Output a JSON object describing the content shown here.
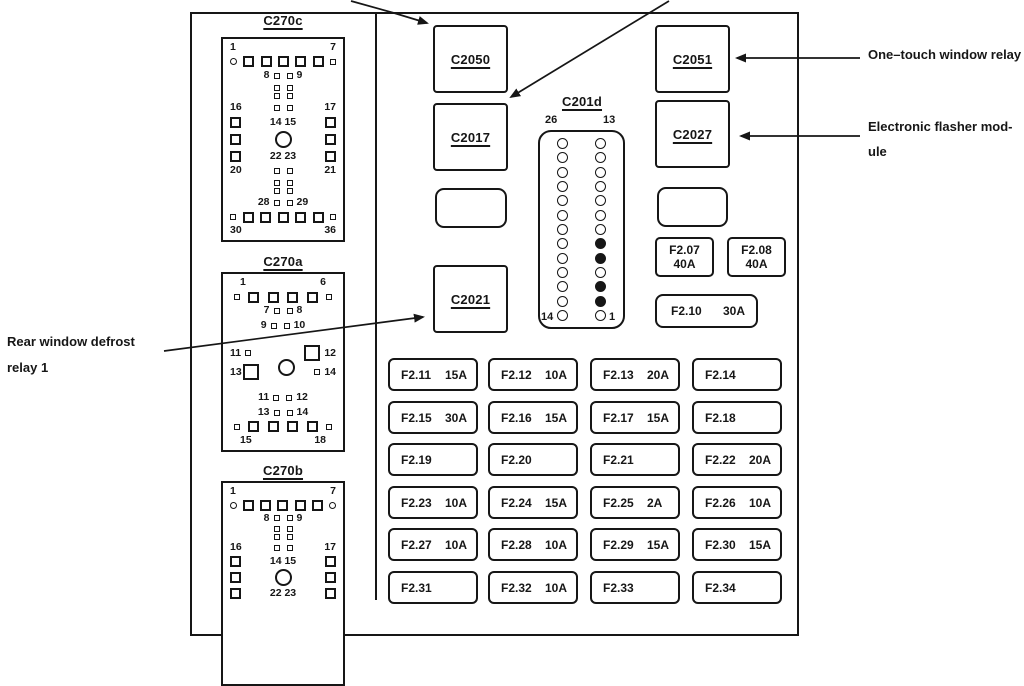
{
  "connectors": {
    "c270c": {
      "title": "C270c",
      "p1": "1",
      "p7": "7",
      "p8": "8",
      "p9": "9",
      "p16": "16",
      "p17": "17",
      "p14_15": "14 15",
      "p22_23": "22 23",
      "p20": "20",
      "p21": "21",
      "p28": "28",
      "p29": "29",
      "p30": "30",
      "p36": "36"
    },
    "c270a": {
      "title": "C270a",
      "p1": "1",
      "p6": "6",
      "p7": "7",
      "p8": "8",
      "p9": "9",
      "p10": "10",
      "p11a": "11",
      "p12a": "12",
      "p13a": "13",
      "p14a": "14",
      "p11b": "11",
      "p12b": "12",
      "p13b": "13",
      "p14b": "14",
      "p15": "15",
      "p18": "18"
    },
    "c270b": {
      "title": "C270b",
      "p1": "1",
      "p7": "7",
      "p8": "8",
      "p9": "9",
      "p16": "16",
      "p17": "17",
      "p14_15": "14 15",
      "p22_23": "22 23"
    },
    "c201d": {
      "title": "C201d",
      "top_left": "26",
      "top_right": "13",
      "bottom_left": "14",
      "bottom_right": "1",
      "pin_rows": 13,
      "right_fill_rows": [
        8,
        9,
        11,
        12
      ]
    },
    "c2050": "C2050",
    "c2017": "C2017",
    "c2021": "C2021",
    "c2051": "C2051",
    "c2027": "C2027"
  },
  "fuses": {
    "f207": {
      "name": "F2.07",
      "amp": "40A"
    },
    "f208": {
      "name": "F2.08",
      "amp": "40A"
    },
    "f210": {
      "name": "F2.10",
      "amp": "30A"
    },
    "grid": [
      [
        {
          "name": "F2.11",
          "amp": "15A"
        },
        {
          "name": "F2.12",
          "amp": "10A"
        },
        {
          "name": "F2.13",
          "amp": "20A"
        },
        {
          "name": "F2.14",
          "amp": ""
        }
      ],
      [
        {
          "name": "F2.15",
          "amp": "30A"
        },
        {
          "name": "F2.16",
          "amp": "15A"
        },
        {
          "name": "F2.17",
          "amp": "15A"
        },
        {
          "name": "F2.18",
          "amp": ""
        }
      ],
      [
        {
          "name": "F2.19",
          "amp": ""
        },
        {
          "name": "F2.20",
          "amp": ""
        },
        {
          "name": "F2.21",
          "amp": ""
        },
        {
          "name": "F2.22",
          "amp": "20A"
        }
      ],
      [
        {
          "name": "F2.23",
          "amp": "10A"
        },
        {
          "name": "F2.24",
          "amp": "15A"
        },
        {
          "name": "F2.25",
          "amp": "2A"
        },
        {
          "name": "F2.26",
          "amp": "10A"
        }
      ],
      [
        {
          "name": "F2.27",
          "amp": "10A"
        },
        {
          "name": "F2.28",
          "amp": "10A"
        },
        {
          "name": "F2.29",
          "amp": "15A"
        },
        {
          "name": "F2.30",
          "amp": "15A"
        }
      ],
      [
        {
          "name": "F2.31",
          "amp": ""
        },
        {
          "name": "F2.32",
          "amp": "10A"
        },
        {
          "name": "F2.33",
          "amp": ""
        },
        {
          "name": "F2.34",
          "amp": ""
        }
      ]
    ]
  },
  "annotations": {
    "one_touch_window_relay": "One–touch window relay",
    "electronic_flasher_line1": "Electronic flasher mod-",
    "electronic_flasher_line2": "ule",
    "rear_defrost_line1": "Rear window defrost",
    "rear_defrost_line2": "relay 1"
  },
  "colors": {
    "line": "#161616",
    "background": "#ffffff"
  }
}
